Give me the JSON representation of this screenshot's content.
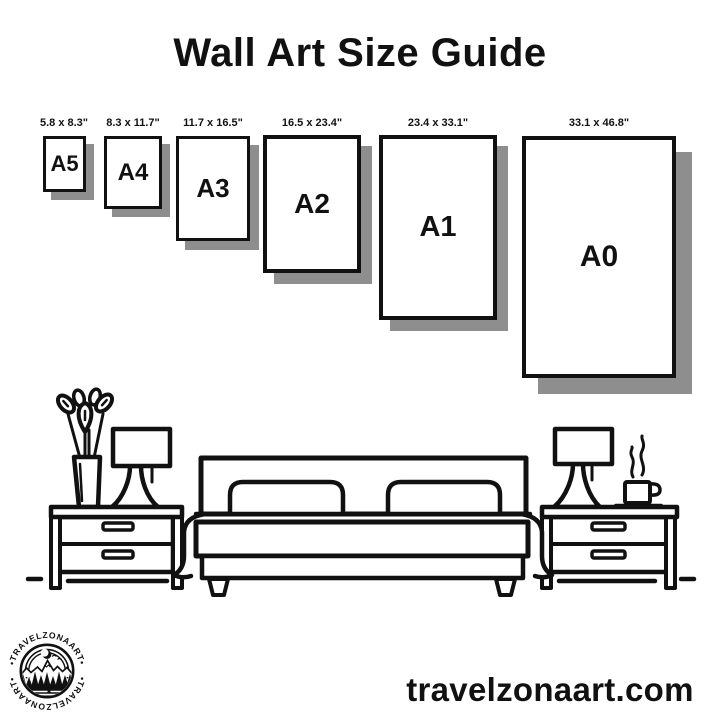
{
  "header": {
    "title": "Wall Art Size Guide"
  },
  "size_guide": {
    "items": [
      {
        "name": "A5",
        "dimensions": "5.8 x 8.3\""
      },
      {
        "name": "A4",
        "dimensions": "8.3 x 11.7\""
      },
      {
        "name": "A3",
        "dimensions": "11.7 x 16.5\""
      },
      {
        "name": "A2",
        "dimensions": "16.5 x 23.4\""
      },
      {
        "name": "A1",
        "dimensions": "23.4 x 33.1\""
      },
      {
        "name": "A0",
        "dimensions": "33.1 x 46.8\""
      }
    ]
  },
  "scene": {
    "icons": [
      "plant-icon",
      "table-lamp-icon",
      "nightstand-icon",
      "bed-icon",
      "coffee-cup-icon",
      "steam-icon",
      "floor-line"
    ]
  },
  "logo": {
    "arc_text_top": "•TRAVELZONAART•",
    "arc_text_bottom": "•TRAVELZONAART•"
  },
  "footer": {
    "website": "travelzonaart.com"
  },
  "colors": {
    "ink": "#111111",
    "paper_shadow": "#8e8e8e",
    "background": "#ffffff"
  }
}
